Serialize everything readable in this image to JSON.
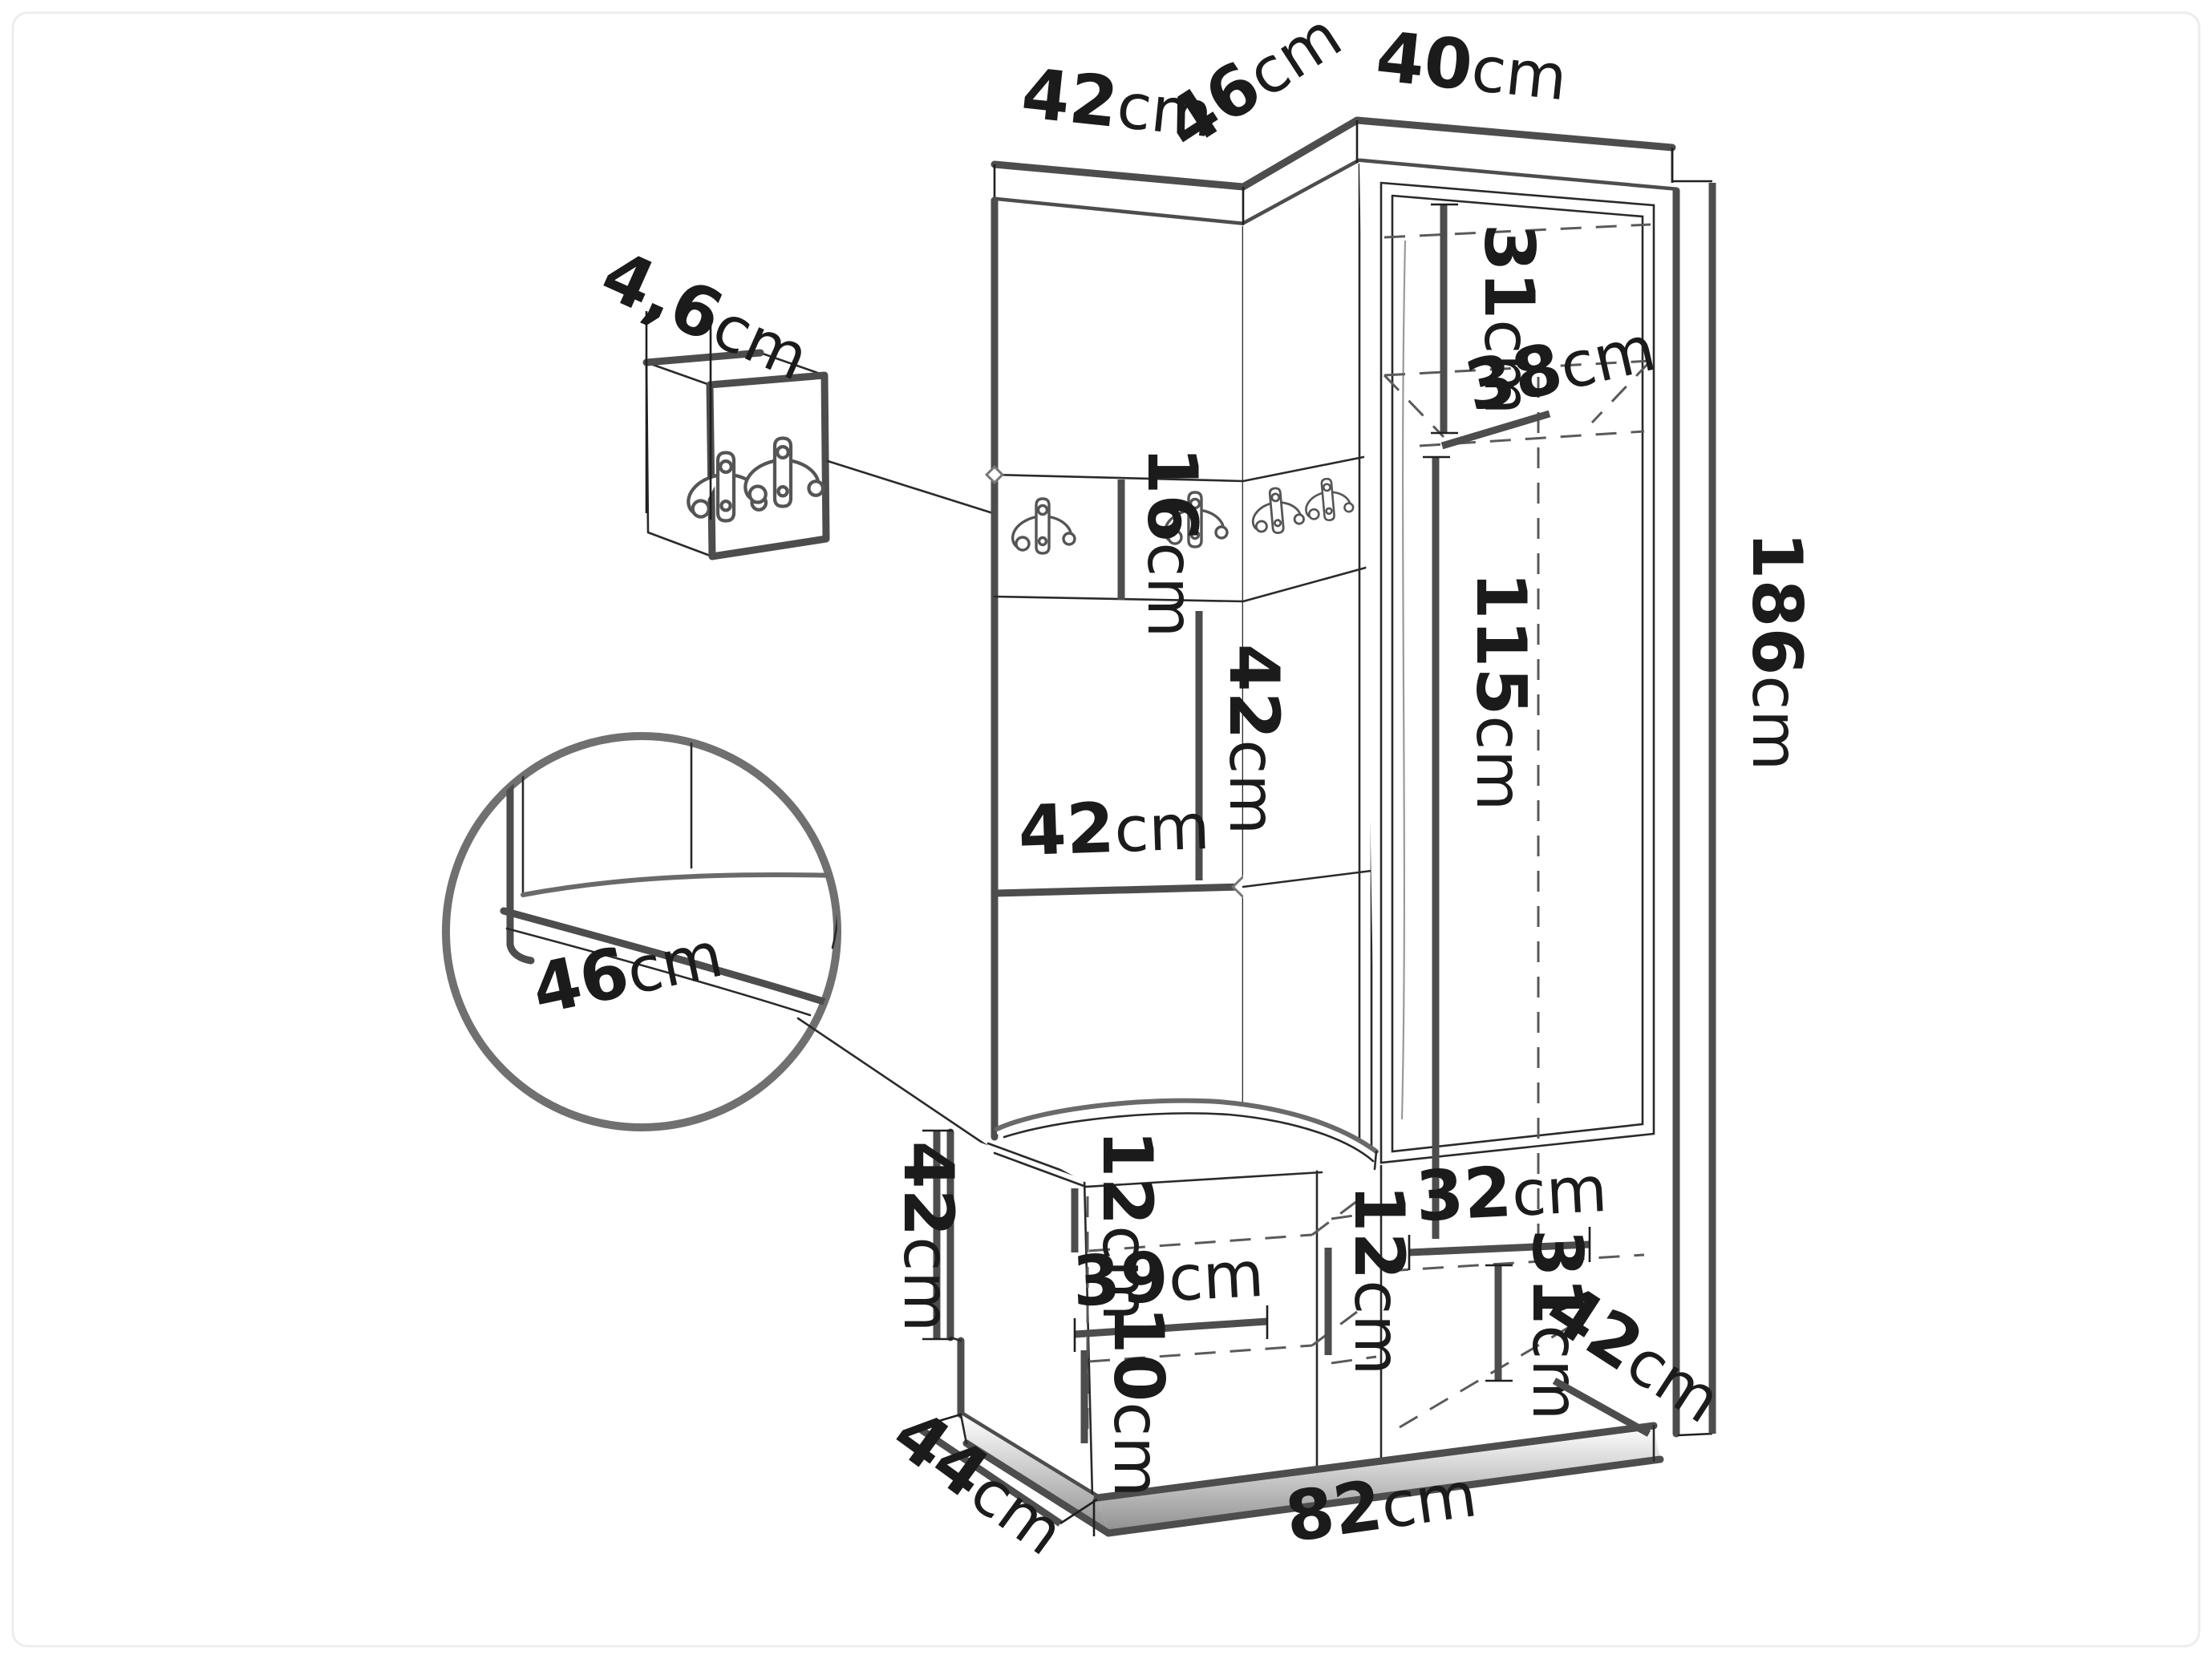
{
  "diagram": {
    "unit_suffix": "cm",
    "colors": {
      "line": "#4d4d4d",
      "thin_line": "#2a2a2a",
      "hidden_dash": "#5a5a5a",
      "text": "#1b1b1b",
      "inset_circle": "#707070",
      "background": "#ffffff"
    },
    "icons": {
      "hook": "double-coat-hook-icon"
    }
  },
  "dims": {
    "top_left_width": {
      "num": "42",
      "unit": "cm"
    },
    "top_mid_depth": {
      "num": "46",
      "unit": "cm"
    },
    "top_right_width": {
      "num": "40",
      "unit": "cm"
    },
    "hook_panel_thickness": {
      "num": "4,6",
      "unit": "cm"
    },
    "upper_compartment_height": {
      "num": "31",
      "unit": "cm"
    },
    "upper_shelf_depth": {
      "num": "38",
      "unit": "cm"
    },
    "hook_strip_height": {
      "num": "16",
      "unit": "cm"
    },
    "middle_opening_height": {
      "num": "42",
      "unit": "cm"
    },
    "middle_shelf_width": {
      "num": "42",
      "unit": "cm"
    },
    "wardrobe_inner_height": {
      "num": "115",
      "unit": "cm"
    },
    "total_height": {
      "num": "186",
      "unit": "cm"
    },
    "seat_depth": {
      "num": "46",
      "unit": "cm"
    },
    "bench_height": {
      "num": "42",
      "unit": "cm"
    },
    "bench_top_opening": {
      "num": "12",
      "unit": "cm"
    },
    "bench_shelf_width": {
      "num": "39",
      "unit": "cm"
    },
    "bench_bottom_opening": {
      "num": "10",
      "unit": "cm"
    },
    "corner_opening": {
      "num": "12",
      "unit": "cm"
    },
    "lower_cabinet_width": {
      "num": "32",
      "unit": "cm"
    },
    "lower_cabinet_height": {
      "num": "31",
      "unit": "cm"
    },
    "lower_cabinet_depth": {
      "num": "42",
      "unit": "cm"
    },
    "base_side_depth": {
      "num": "44",
      "unit": "cm"
    },
    "base_front_width": {
      "num": "82",
      "unit": "cm"
    }
  }
}
